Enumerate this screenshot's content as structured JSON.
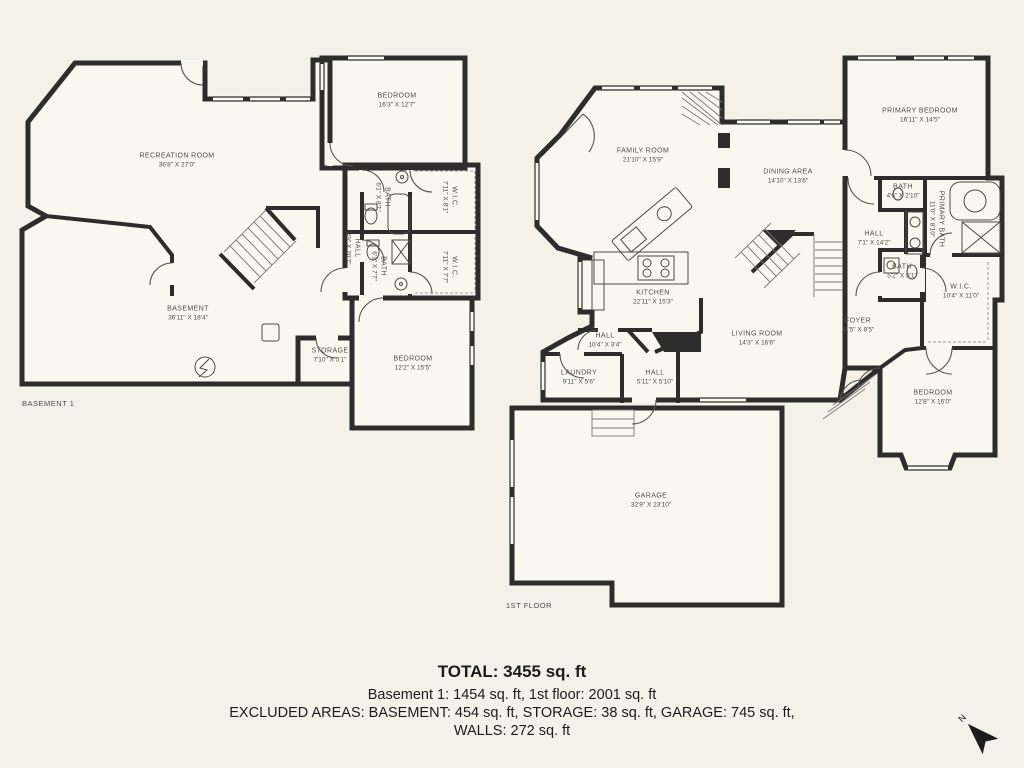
{
  "title_block": {
    "total": "TOTAL: 3455 sq. ft",
    "floors": "Basement 1: 1454 sq. ft, 1st floor: 2001 sq. ft",
    "excluded": "EXCLUDED AREAS: BASEMENT: 454 sq. ft, STORAGE: 38 sq. ft, GARAGE: 745 sq. ft,",
    "walls": "WALLS: 272 sq. ft"
  },
  "compass": {
    "north_label": "N"
  },
  "colors": {
    "background": "#f4f2e8",
    "wall": "#2d2d2d",
    "room_fill": "#f9f8f0",
    "label": "#4d4d4d"
  },
  "basement": {
    "floor_label": "BASEMENT 1",
    "rooms": {
      "recreation": {
        "name": "RECREATION ROOM",
        "dims": "36'8\" X 27'0\""
      },
      "basement": {
        "name": "BASEMENT",
        "dims": "36'11\" X 18'4\""
      },
      "bedroom_top": {
        "name": "BEDROOM",
        "dims": "16'3\" X 12'7\""
      },
      "bath_top": {
        "name": "BATH",
        "dims": "6'1\" X 8'1\""
      },
      "wic_top": {
        "name": "W.I.C.",
        "dims": "7'11\" X 8'1\""
      },
      "hall": {
        "name": "HALL",
        "dims": "3'9\" X 20'7\""
      },
      "bath_bottom": {
        "name": "BATH",
        "dims": "6'1\" X 7'7\""
      },
      "wic_bottom": {
        "name": "W.I.C.",
        "dims": "7'11\" X 7'7\""
      },
      "storage": {
        "name": "STORAGE",
        "dims": "7'10\" X 5'1\""
      },
      "bedroom_bottom": {
        "name": "BEDROOM",
        "dims": "12'2\" X 15'5\""
      }
    }
  },
  "first_floor": {
    "floor_label": "1ST FLOOR",
    "rooms": {
      "family": {
        "name": "FAMILY ROOM",
        "dims": "21'10\" X 15'9\""
      },
      "dining": {
        "name": "DINING AREA",
        "dims": "14'10\" X 13'6\""
      },
      "primary_bedroom": {
        "name": "PRIMARY BEDROOM",
        "dims": "16'11\" X 14'5\""
      },
      "bath_small": {
        "name": "BATH",
        "dims": "4'6\" X 2'10\""
      },
      "primary_bath": {
        "name": "PRIMARY BATH",
        "dims": "11'0\" X 8'10\""
      },
      "hall_upper": {
        "name": "HALL",
        "dims": "7'1\" X 14'2\""
      },
      "bath_mid": {
        "name": "BATH",
        "dims": "5'2\" X 5'1\""
      },
      "wic": {
        "name": "W.I.C.",
        "dims": "10'4\" X 11'0\""
      },
      "foyer": {
        "name": "FOYER",
        "dims": "11'5\" X 8'5\""
      },
      "bedroom": {
        "name": "BEDROOM",
        "dims": "12'8\" X 16'0\""
      },
      "living": {
        "name": "LIVING ROOM",
        "dims": "14'3\" X 16'6\""
      },
      "kitchen": {
        "name": "KITCHEN",
        "dims": "22'11\" X 15'3\""
      },
      "hall_mid": {
        "name": "HALL",
        "dims": "10'4\" X 3'4\""
      },
      "laundry": {
        "name": "LAUNDRY",
        "dims": "9'11\" X 5'6\""
      },
      "hall_lower": {
        "name": "HALL",
        "dims": "5'11\" X 5'10\""
      },
      "garage": {
        "name": "GARAGE",
        "dims": "32'9\" X 23'10\""
      }
    }
  }
}
